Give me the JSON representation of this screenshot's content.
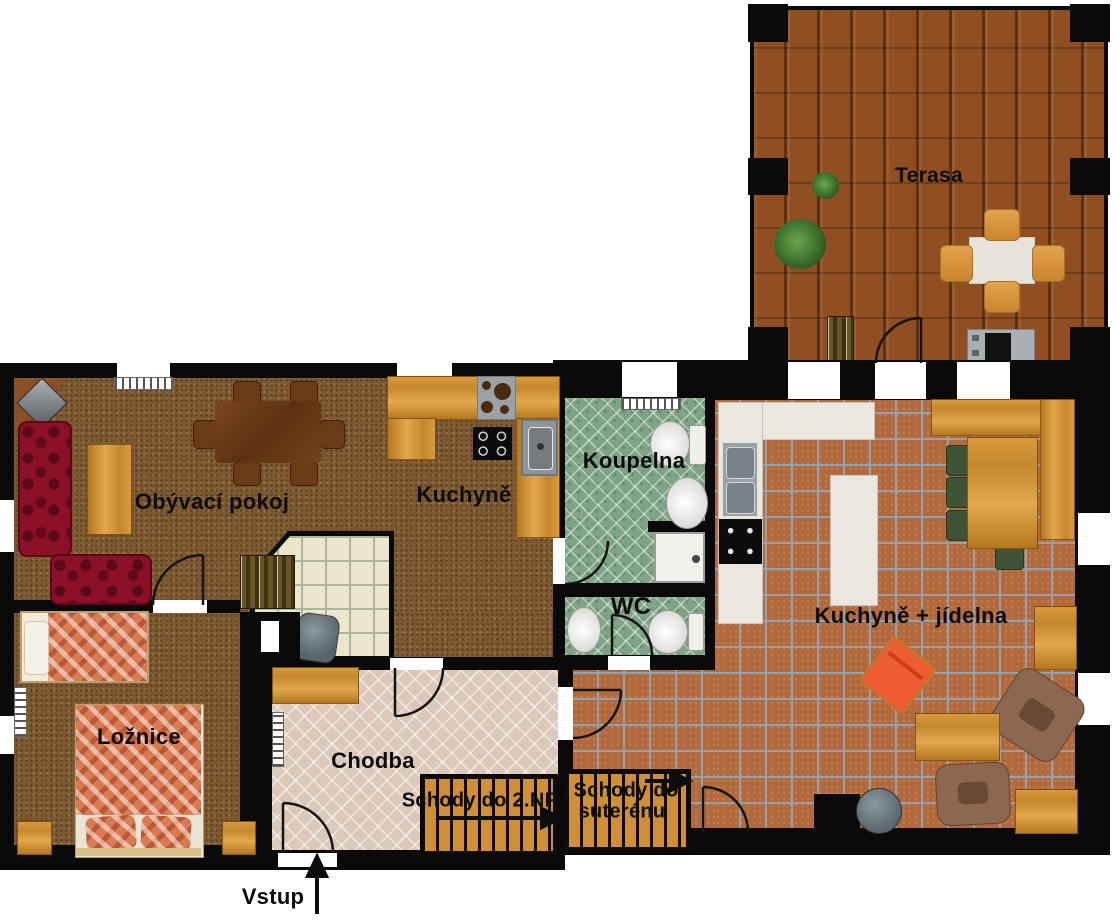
{
  "rooms": {
    "terasa": {
      "label": "Terasa"
    },
    "obyvaci_pokoj": {
      "label": "Obývací pokoj"
    },
    "kuchyne": {
      "label": "Kuchyně"
    },
    "koupelna": {
      "label": "Koupelna"
    },
    "wc": {
      "label": "WC"
    },
    "kuchyne_jidelna": {
      "label": "Kuchyně + jídelna"
    },
    "loznice": {
      "label": "Ložnice"
    },
    "chodba": {
      "label": "Chodba"
    }
  },
  "stairs": {
    "upper": {
      "label": "Schody do 2.NP"
    },
    "basement": {
      "line1": "Schody do",
      "line2": "suterénu"
    }
  },
  "entrance": {
    "label": "Vstup"
  },
  "colors": {
    "wall": "#0a0a0a",
    "terrace_wood": "#8f4f22",
    "carpet": "#7d5a32",
    "hall_tile": "#dbc8b8",
    "bath_tile": "#7fa387",
    "kitchen_tile": "#b2693c",
    "stove_alcove_tile": "#ece4cb",
    "stair_wood": "#cf8f34",
    "counter_white": "#eae7e0",
    "sofa_red": "#8c1126",
    "bed_plaid_orange": "#d97a50",
    "chair_green": "#3e5434",
    "lounge_chair_orange": "#f26440"
  }
}
